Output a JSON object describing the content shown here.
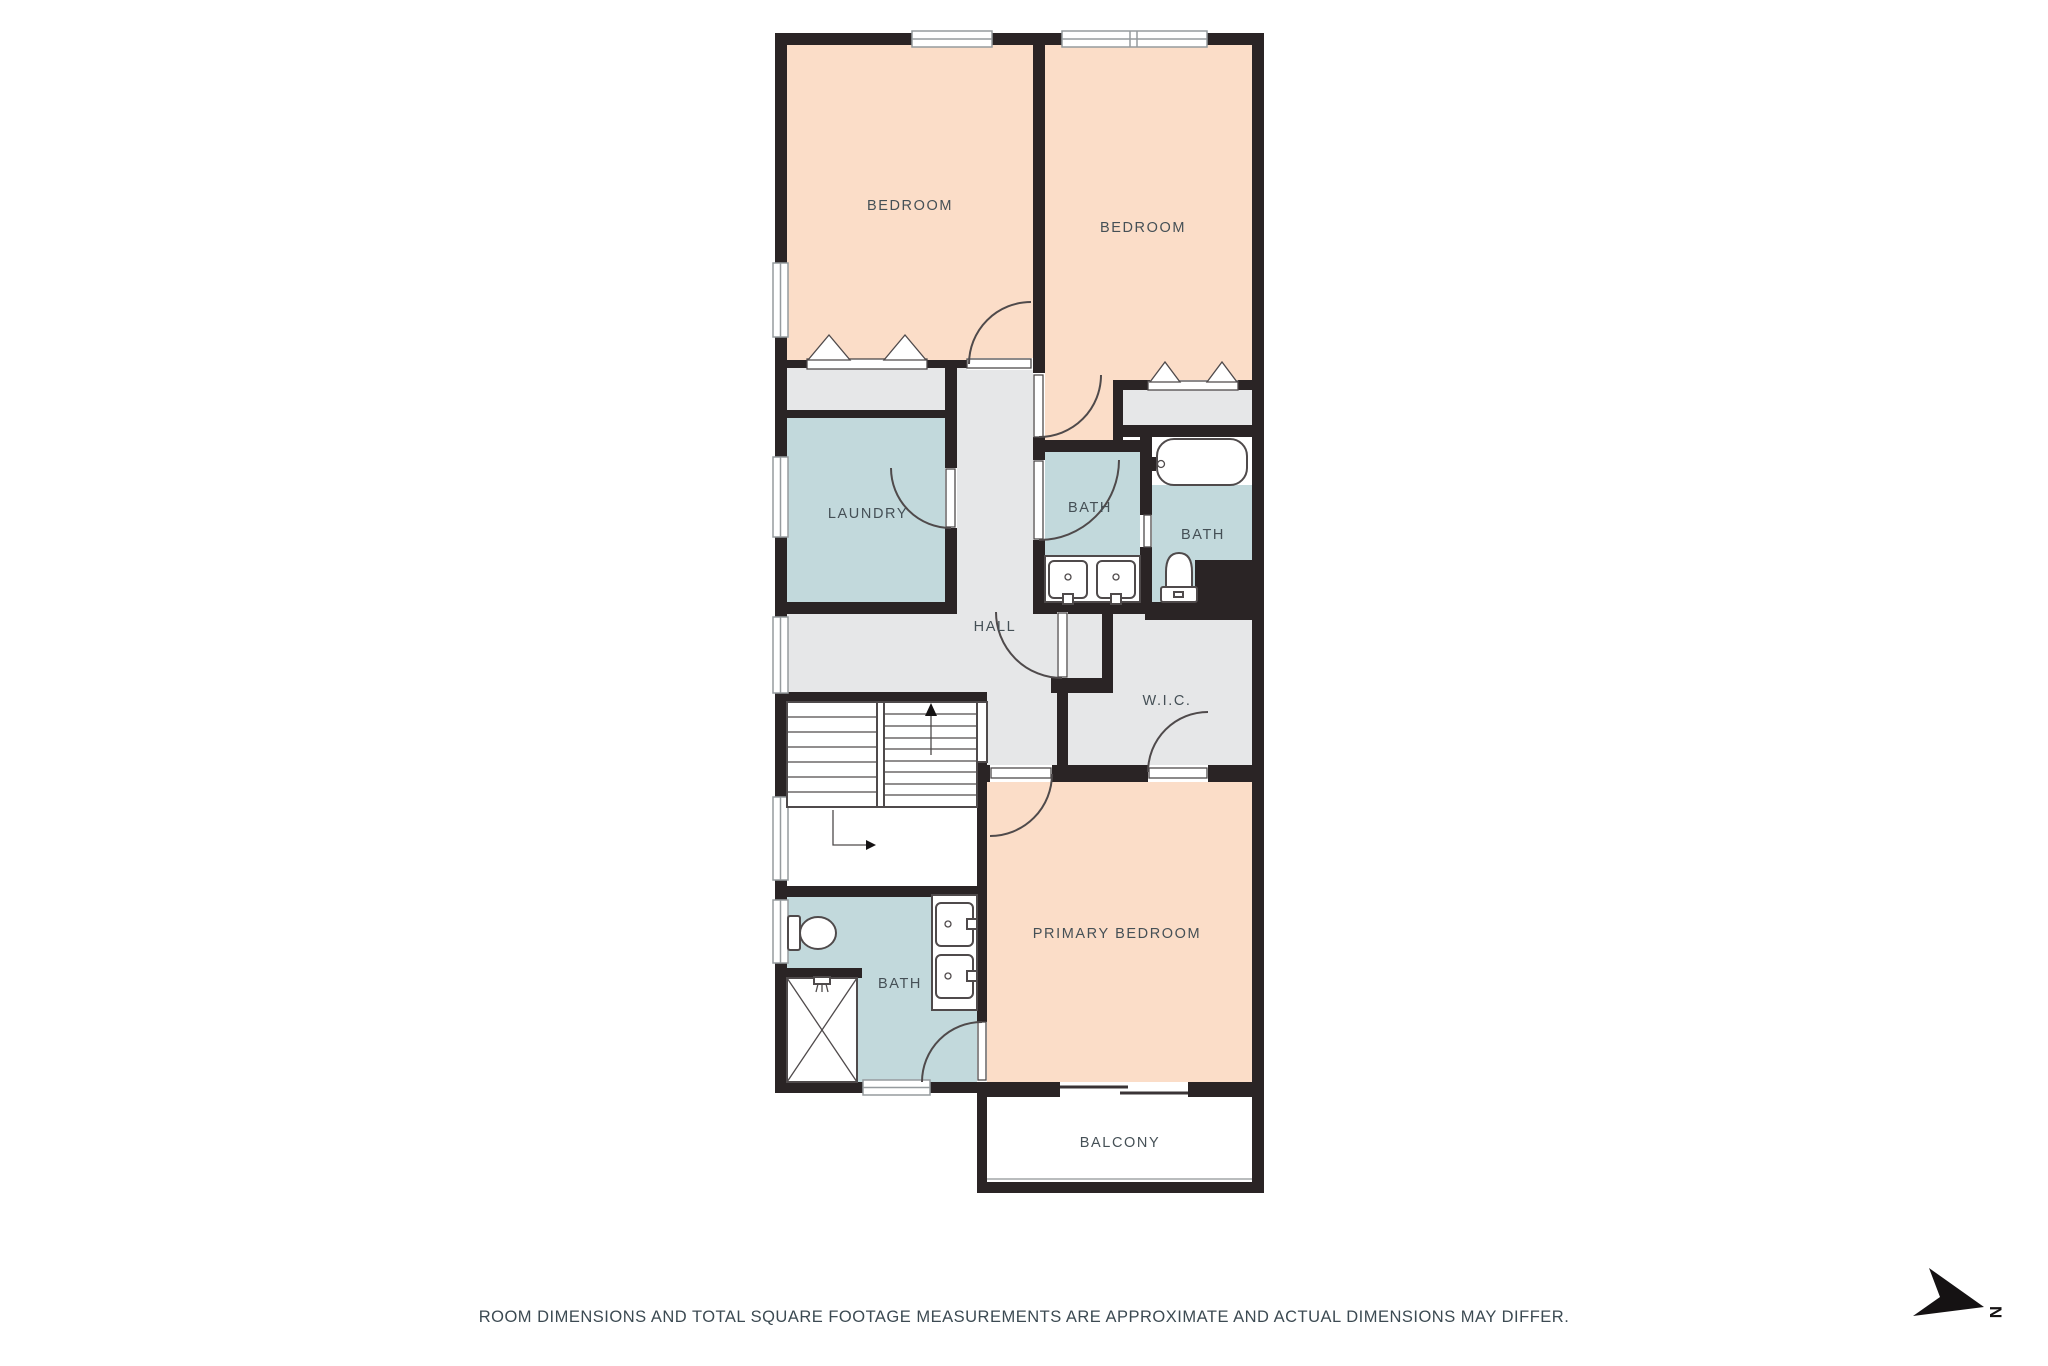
{
  "disclaimer": "ROOM DIMENSIONS AND TOTAL SQUARE FOOTAGE MEASUREMENTS ARE APPROXIMATE AND ACTUAL DIMENSIONS MAY DIFFER.",
  "compass": {
    "label": "N"
  },
  "palette": {
    "wall": "#2a2425",
    "peach": "#fbddc8",
    "blue": "#c2d9dc",
    "gray": "#e6e7e8",
    "line": "#4f4a4b",
    "label": "#455056"
  },
  "rooms": {
    "bedroom_left": "BEDROOM",
    "bedroom_right": "BEDROOM",
    "laundry": "LAUNDRY",
    "bath_center": "BATH",
    "bath_right": "BATH",
    "hall": "HALL",
    "wic": "W.I.C.",
    "primary_bedroom": "PRIMARY BEDROOM",
    "bath_lower": "BATH",
    "balcony": "BALCONY"
  }
}
